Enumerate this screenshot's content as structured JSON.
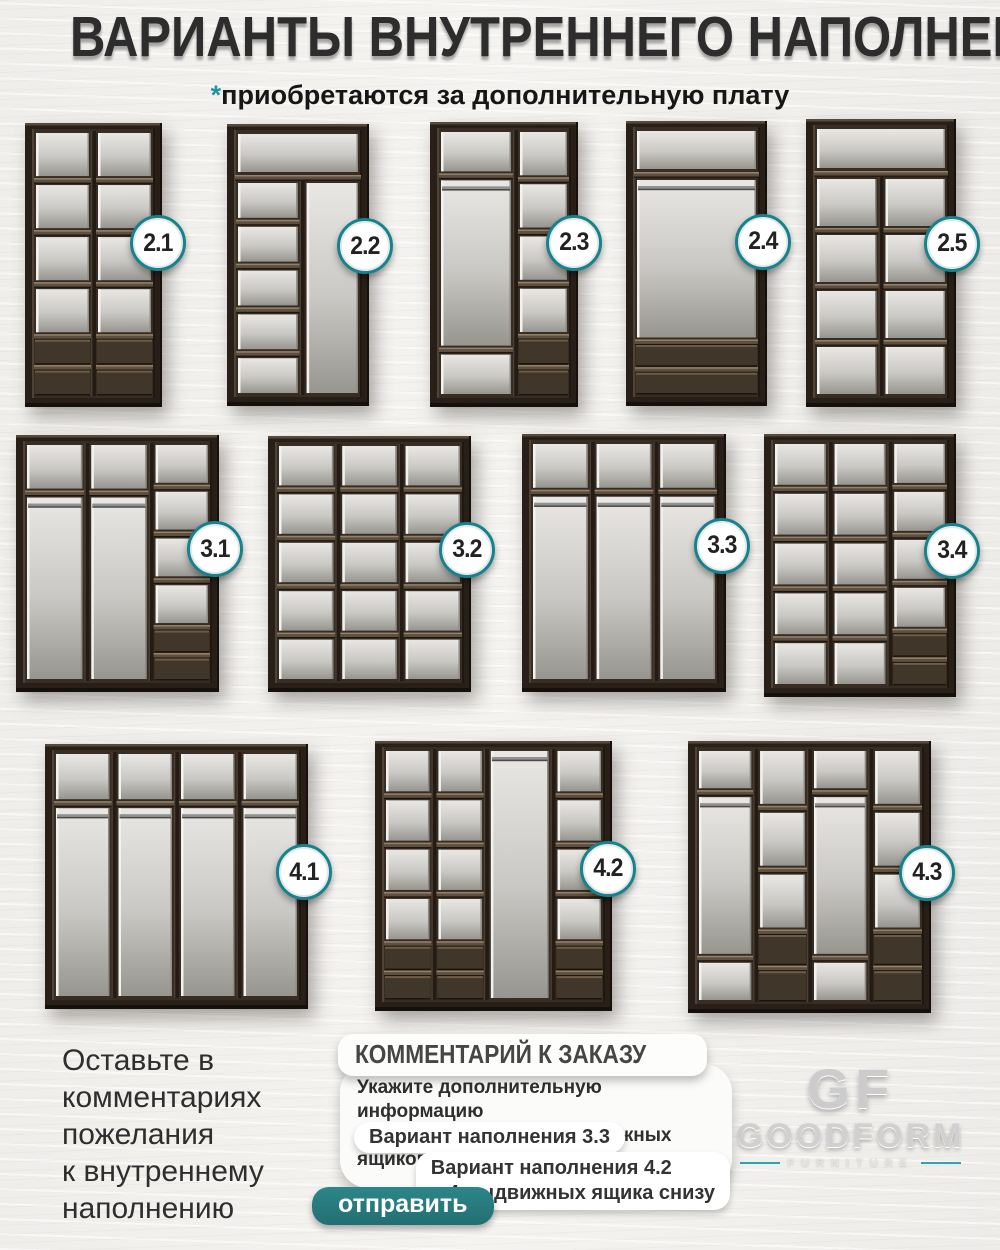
{
  "header": {
    "title": "ВАРИАНТЫ ВНУТРЕННЕГО НАПОЛНЕНИЯ",
    "asterisk": "*",
    "subtitle_star": "*",
    "subtitle": "приобретаются за дополнительную плату"
  },
  "colors": {
    "accent_teal": "#1a96a0",
    "badge_ring": "#17828c",
    "button_teal": "#28797c",
    "wood_dark": "#281f18",
    "back_panel": "#c9c8c4",
    "background": "#f2f0ed"
  },
  "wardrobes": {
    "variants": [
      {
        "label": "2.1",
        "top_shelf": false,
        "cols": [
          {
            "w": 1,
            "segs": [
              "c",
              "c",
              "c",
              "c",
              "d",
              "d"
            ]
          },
          {
            "w": 1,
            "segs": [
              "c",
              "c",
              "c",
              "c",
              "d",
              "d"
            ]
          }
        ]
      },
      {
        "label": "2.2",
        "top_shelf": true,
        "cols": [
          {
            "w": 1.15,
            "segs": [
              "c",
              "c",
              "c",
              "c",
              "c"
            ]
          },
          {
            "w": 1,
            "segs": [
              "o"
            ]
          }
        ]
      },
      {
        "label": "2.3",
        "top_shelf": false,
        "cols": [
          {
            "w": 1.45,
            "segs": [
              "c",
              "h",
              "c"
            ]
          },
          {
            "w": 1,
            "segs": [
              "c",
              "c",
              "c",
              "c",
              "d",
              "d"
            ]
          }
        ]
      },
      {
        "label": "2.4",
        "top_shelf": true,
        "cols": [
          {
            "w": 1,
            "segs": [
              "h",
              "d",
              "d"
            ]
          }
        ]
      },
      {
        "label": "2.5",
        "top_shelf": true,
        "cols": [
          {
            "w": 1,
            "segs": [
              "c",
              "c",
              "c",
              "c"
            ]
          },
          {
            "w": 1,
            "segs": [
              "c",
              "c",
              "c",
              "c"
            ]
          }
        ]
      },
      {
        "label": "3.1",
        "top_shelf": false,
        "cols": [
          {
            "w": 1,
            "segs": [
              "c",
              "h"
            ]
          },
          {
            "w": 1,
            "segs": [
              "c",
              "h"
            ]
          },
          {
            "w": 0.95,
            "segs": [
              "c",
              "c",
              "c",
              "c",
              "d",
              "d"
            ]
          }
        ]
      },
      {
        "label": "3.2",
        "top_shelf": false,
        "cols": [
          {
            "w": 1,
            "segs": [
              "c",
              "c",
              "c",
              "c",
              "c"
            ]
          },
          {
            "w": 1,
            "segs": [
              "c",
              "c",
              "c",
              "c",
              "c"
            ]
          },
          {
            "w": 1,
            "segs": [
              "c",
              "c",
              "c",
              "c",
              "c"
            ]
          }
        ]
      },
      {
        "label": "3.3",
        "top_shelf": false,
        "cols": [
          {
            "w": 1,
            "segs": [
              "c",
              "h"
            ]
          },
          {
            "w": 1,
            "segs": [
              "c",
              "h"
            ]
          },
          {
            "w": 1,
            "segs": [
              "c",
              "h"
            ]
          }
        ]
      },
      {
        "label": "3.4",
        "top_shelf": false,
        "cols": [
          {
            "w": 1,
            "segs": [
              "c",
              "c",
              "c",
              "c",
              "c"
            ]
          },
          {
            "w": 1,
            "segs": [
              "c",
              "c",
              "c",
              "c",
              "c"
            ]
          },
          {
            "w": 1,
            "segs": [
              "c",
              "c",
              "c",
              "c",
              "d",
              "d"
            ]
          }
        ]
      },
      {
        "label": "4.1",
        "top_shelf": false,
        "cols": [
          {
            "w": 1,
            "segs": [
              "c",
              "h"
            ]
          },
          {
            "w": 1,
            "segs": [
              "c",
              "h"
            ]
          },
          {
            "w": 1,
            "segs": [
              "c",
              "h"
            ]
          },
          {
            "w": 1,
            "segs": [
              "c",
              "h"
            ]
          }
        ]
      },
      {
        "label": "4.2",
        "top_shelf": false,
        "cols": [
          {
            "w": 1,
            "segs": [
              "c",
              "c",
              "c",
              "c",
              "d",
              "d"
            ]
          },
          {
            "w": 1,
            "segs": [
              "c",
              "c",
              "c",
              "c",
              "d",
              "d"
            ]
          },
          {
            "w": 1.3,
            "segs": [
              "h"
            ]
          },
          {
            "w": 1,
            "segs": [
              "c",
              "c",
              "c",
              "c",
              "d",
              "d"
            ]
          }
        ]
      },
      {
        "label": "4.3",
        "top_shelf": false,
        "cols": [
          {
            "w": 1.15,
            "segs": [
              "c",
              "h",
              "c"
            ]
          },
          {
            "w": 1,
            "segs": [
              "c",
              "c",
              "c",
              "d",
              "d"
            ]
          },
          {
            "w": 1.15,
            "segs": [
              "c",
              "h",
              "c"
            ]
          },
          {
            "w": 1,
            "segs": [
              "c",
              "c",
              "c",
              "d",
              "d"
            ]
          }
        ]
      }
    ]
  },
  "footer": {
    "note_lines": [
      "Оставьте в",
      "комментариях",
      "пожелания",
      "к внутреннему",
      "наполнению"
    ],
    "comment": {
      "header": "КОММЕНТАРИЙ К ЗАКАЗУ",
      "info_line1": "Укажите дополнительную информацию",
      "info_line2": "к заказу: количество выдвижных ящиков, полок",
      "bubble1": "Вариант наполнения 3.3",
      "bubble2_line1": "Вариант наполнения 4.2",
      "bubble2_line2": "+ 4 выдвижных ящика снизу",
      "send_button": "отправить"
    },
    "logo": {
      "monogram": "GF",
      "name": "GOODFORM",
      "tagline": "FURNITURE"
    }
  }
}
